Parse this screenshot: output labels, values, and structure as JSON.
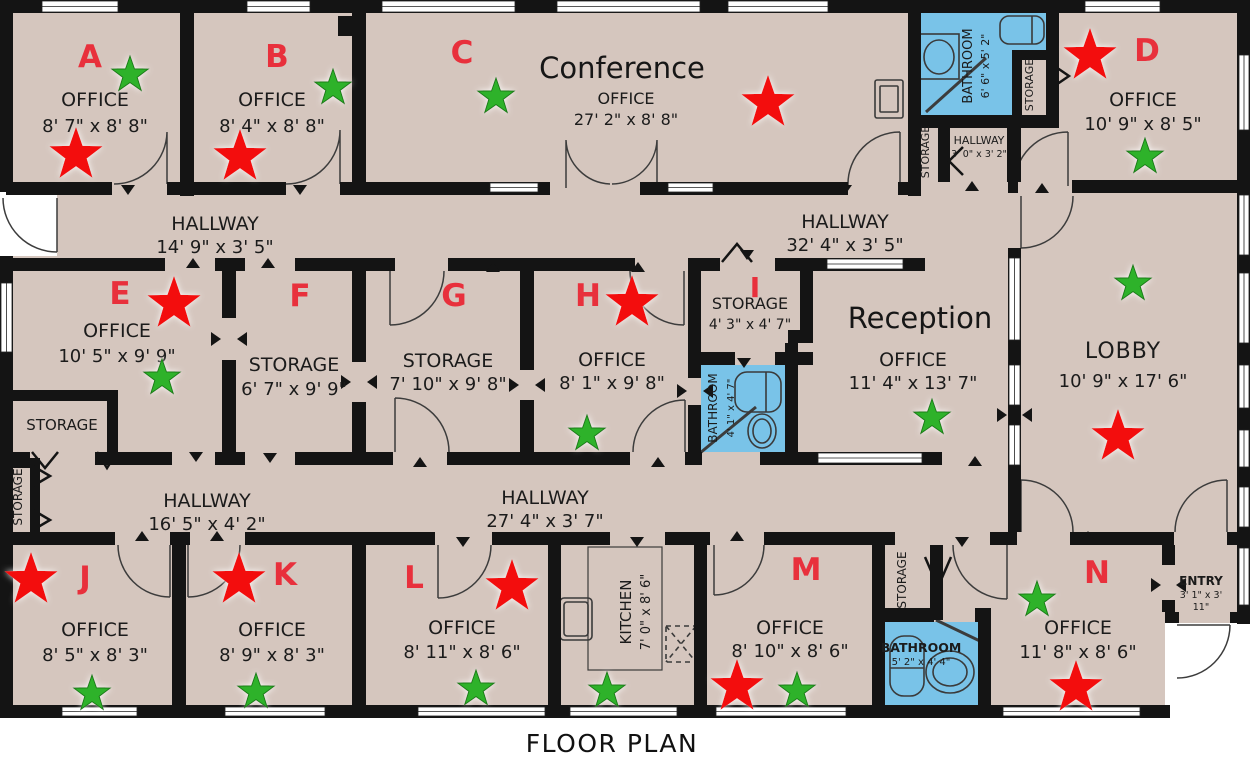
{
  "title": "FLOOR PLAN",
  "colors": {
    "floor": "#d5c6be",
    "wall": "#141414",
    "bathroom": "#79c3e8",
    "room_letter": "#e8303c",
    "red_star": "#f30d11",
    "green_star": "#2eb22b",
    "label_text": "#1b1b1b"
  },
  "rooms": {
    "a": {
      "letter": "A",
      "type": "OFFICE",
      "dims": "8' 7\" x 8' 8\""
    },
    "b": {
      "letter": "B",
      "type": "OFFICE",
      "dims": "8' 4\" x 8' 8\""
    },
    "c": {
      "letter": "C",
      "name": "Conference",
      "type": "OFFICE",
      "dims": "27' 2\" x 8' 8\""
    },
    "d": {
      "letter": "D",
      "type": "OFFICE",
      "dims": "10' 9\" x 8' 5\""
    },
    "e": {
      "letter": "E",
      "type": "OFFICE",
      "dims": "10' 5\" x 9' 9\""
    },
    "f": {
      "letter": "F",
      "type": "STORAGE",
      "dims": "6' 7\" x 9' 9\""
    },
    "g": {
      "letter": "G",
      "type": "STORAGE",
      "dims": "7' 10\" x 9' 8\""
    },
    "h": {
      "letter": "H",
      "type": "OFFICE",
      "dims": "8' 1\" x 9' 8\""
    },
    "i": {
      "letter": "I",
      "type": "STORAGE",
      "dims": "4' 3\" x 4' 7\""
    },
    "j": {
      "letter": "J",
      "type": "OFFICE",
      "dims": "8' 5\" x 8' 3\""
    },
    "k": {
      "letter": "K",
      "type": "OFFICE",
      "dims": "8' 9\" x 8' 3\""
    },
    "l": {
      "letter": "L",
      "type": "OFFICE",
      "dims": "8' 11\" x 8' 6\""
    },
    "m": {
      "letter": "M",
      "type": "OFFICE",
      "dims": "8' 10\" x 8' 6\""
    },
    "n": {
      "letter": "N",
      "type": "OFFICE",
      "dims": "11' 8\" x 8' 6\""
    },
    "reception": {
      "name": "Reception",
      "type": "OFFICE",
      "dims": "11' 4\" x 13' 7\""
    },
    "lobby": {
      "type": "LOBBY",
      "dims": "10' 9\" x 17' 6\""
    },
    "kitchen": {
      "type": "KITCHEN",
      "dims": "7' 0\" x 8' 6\""
    },
    "entry": {
      "type": "ENTRY",
      "dims_line1": "3' 1\" x 3'",
      "dims_line2": "11\""
    }
  },
  "hallways": {
    "top_left": {
      "name": "HALLWAY",
      "dims": "14' 9\" x 3' 5\""
    },
    "top_right": {
      "name": "HALLWAY",
      "dims": "32' 4\" x 3' 5\""
    },
    "bottom_left": {
      "name": "HALLWAY",
      "dims": "16' 5\" x 4' 2\""
    },
    "bottom_right": {
      "name": "HALLWAY",
      "dims": "27' 4\" x 3' 7\""
    },
    "small": {
      "name": "HALLWAY",
      "dims": "3' 0\" x 3' 2\""
    }
  },
  "bathrooms": {
    "top": {
      "name": "BATHROOM",
      "dims": "6' 6\" x 5' 2\""
    },
    "middle": {
      "name": "BATHROOM",
      "dims": "4' 1\" x 4' 7\""
    },
    "bottom": {
      "name": "BATHROOM",
      "dims": "5' 2\" x 4' 4\""
    }
  },
  "closets": {
    "top_right": "STORAGE",
    "small_hall": "STORAGE",
    "room_e": "STORAGE",
    "far_left": "STORAGE",
    "bottom": "STORAGE"
  },
  "stars": {
    "red": [
      {
        "x": 76,
        "y": 155
      },
      {
        "x": 240,
        "y": 157
      },
      {
        "x": 768,
        "y": 103
      },
      {
        "x": 1090,
        "y": 56
      },
      {
        "x": 174,
        "y": 304
      },
      {
        "x": 632,
        "y": 303
      },
      {
        "x": 1118,
        "y": 437
      },
      {
        "x": 31,
        "y": 580
      },
      {
        "x": 239,
        "y": 580
      },
      {
        "x": 512,
        "y": 587
      },
      {
        "x": 737,
        "y": 687
      },
      {
        "x": 1076,
        "y": 688
      }
    ],
    "green": [
      {
        "x": 130,
        "y": 75
      },
      {
        "x": 333,
        "y": 88
      },
      {
        "x": 496,
        "y": 97
      },
      {
        "x": 1145,
        "y": 157
      },
      {
        "x": 162,
        "y": 378
      },
      {
        "x": 587,
        "y": 434
      },
      {
        "x": 932,
        "y": 418
      },
      {
        "x": 1133,
        "y": 284
      },
      {
        "x": 92,
        "y": 694
      },
      {
        "x": 256,
        "y": 692
      },
      {
        "x": 476,
        "y": 689
      },
      {
        "x": 607,
        "y": 691
      },
      {
        "x": 797,
        "y": 691
      },
      {
        "x": 1037,
        "y": 600
      }
    ]
  }
}
